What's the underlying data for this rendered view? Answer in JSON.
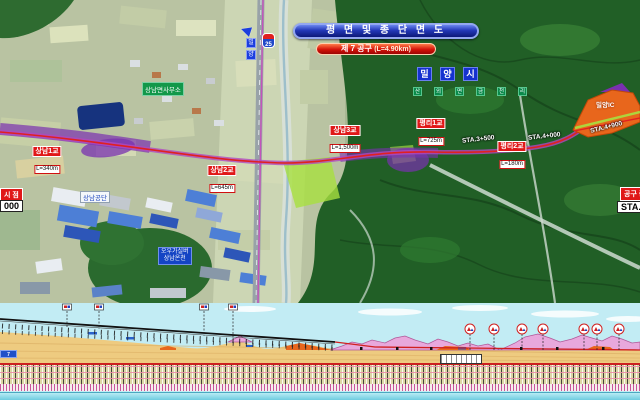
{
  "banners": {
    "title": "평 면 및 종 단 면 도",
    "section": "제 7 공구",
    "section_length": "(L=4.90km)"
  },
  "city_boxes": [
    "밀",
    "양",
    "시"
  ],
  "village_boxes": [
    "산",
    "외",
    "면",
    "금",
    "천",
    "리"
  ],
  "places": {
    "township": "상남면사무소",
    "industrial": "상남공단",
    "resort_line1": "오우가실버",
    "resort_line2": "상남온천",
    "interchange": "밀양IC",
    "route_no": "25"
  },
  "direction_boxes": [
    "밀",
    "양"
  ],
  "bridges": [
    {
      "name": "상남1교",
      "length": "L=340m"
    },
    {
      "name": "상남2교",
      "length": "L=645m"
    },
    {
      "name": "상남3교",
      "length": "L=1,500m"
    },
    {
      "name": "평리1교",
      "length": "L=725m"
    },
    {
      "name": "평리2교",
      "length": "L=180m"
    }
  ],
  "stations": {
    "s1": "STA.3+500",
    "s2": "STA.4+000",
    "s3": "STA.4+900"
  },
  "markers": {
    "start_label": "시 점",
    "start_sta": "000",
    "end_label": "공구 종점",
    "end_sta": "STA.4+900"
  },
  "profile": {
    "tag": "7"
  },
  "colors": {
    "route_red": "#e02020",
    "route_purple": "#7a30b0",
    "banner_blue": "#1a2a9e",
    "banner_red": "#d41208",
    "ground_tan": "#eecb80",
    "hill_pink": "#e8a8dc",
    "cut_orange": "#e8661c",
    "sky_cyan": "#c2ecf4"
  }
}
